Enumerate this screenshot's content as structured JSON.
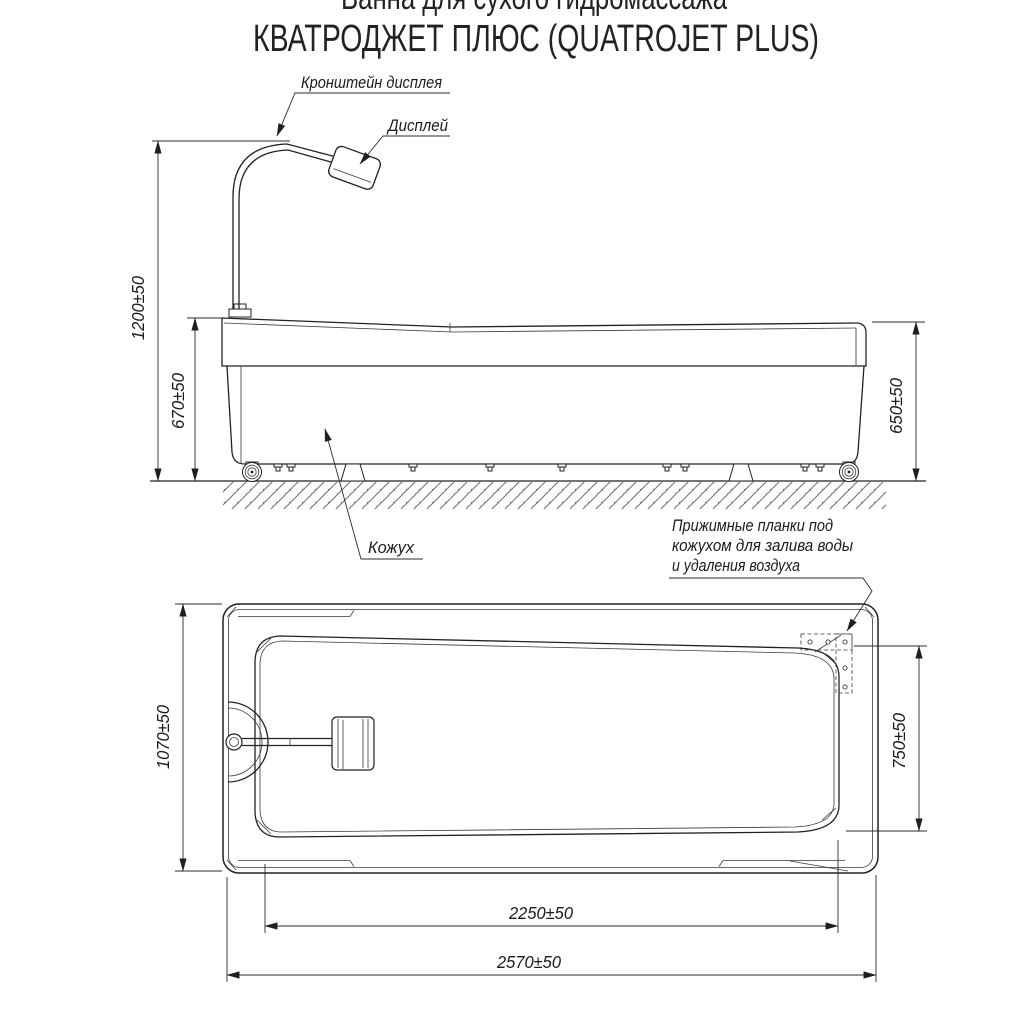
{
  "title": {
    "line1": "Ванна для сухого гидромассажа",
    "line2": "КВАТРОДЖЕТ ПЛЮС (QUATROJET PLUS)"
  },
  "side_view": {
    "label_display_bracket": "Кронштейн дисплея",
    "label_display": "Дисплей",
    "label_casing": "Кожух",
    "dim_overall_height": "1200±50",
    "dim_casing_height": "670±50",
    "dim_tub_height": "650±50"
  },
  "plan_view": {
    "annotation_plates_line1": "Прижимные планки под",
    "annotation_plates_line2": "кожухом для залива воды",
    "annotation_plates_line3": "и удаления воздуха",
    "dim_overall_width": "1070±50",
    "dim_inner_width": "750±50",
    "dim_inner_length": "2250±50",
    "dim_overall_length": "2570±50"
  },
  "colors": {
    "line": "#222222",
    "hatch": "#6f6f6f",
    "background": "#ffffff"
  }
}
